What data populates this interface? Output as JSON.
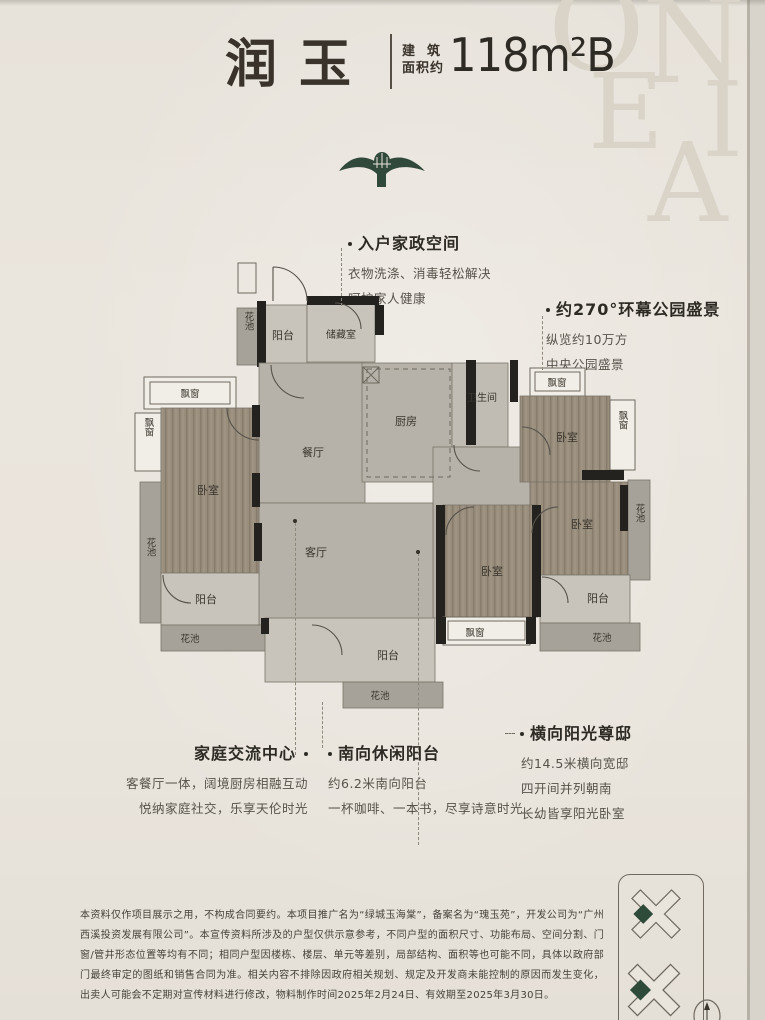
{
  "header": {
    "title": "润玉",
    "area_label_line1": "建筑",
    "area_label_line2": "面积约",
    "area_value": "118m²B"
  },
  "watermark": {
    "letters": [
      "O",
      "N",
      "E",
      "I",
      "A"
    ]
  },
  "annotations": {
    "entry": {
      "title": "入户家政空间",
      "lines": [
        "衣物洗涤、消毒轻松解决",
        "呵护家人健康"
      ]
    },
    "park": {
      "title": "约270°环幕公园盛景",
      "lines": [
        "纵览约10万方",
        "中央公园盛景"
      ]
    },
    "family": {
      "title": "家庭交流中心",
      "lines": [
        "客餐厅一体，阔境厨房相融互动",
        "悦纳家庭社交，乐享天伦时光"
      ]
    },
    "south_balcony": {
      "title": "南向休闲阳台",
      "lines": [
        "约6.2米南向阳台",
        "一杯咖啡、一本书，尽享诗意时光"
      ]
    },
    "sunshine": {
      "title": "横向阳光尊邸",
      "lines": [
        "约14.5米横向宽邸",
        "四开间并列朝南",
        "长幼皆享阳光卧室"
      ]
    }
  },
  "floor_plan": {
    "rooms": [
      {
        "id": "flower-top",
        "label": "花池"
      },
      {
        "id": "entry-balcony",
        "label": "阳台"
      },
      {
        "id": "storage",
        "label": "储藏室"
      },
      {
        "id": "bay-top-left",
        "label": "飘窗"
      },
      {
        "id": "bay-left",
        "label": "飘窗"
      },
      {
        "id": "bedroom-left",
        "label": "卧室"
      },
      {
        "id": "dining",
        "label": "餐厅"
      },
      {
        "id": "kitchen",
        "label": "厨房"
      },
      {
        "id": "bathroom",
        "label": "卫生间"
      },
      {
        "id": "bay-top-right",
        "label": "飘窗"
      },
      {
        "id": "bedroom-top-right",
        "label": "卧室"
      },
      {
        "id": "bay-right",
        "label": "飘窗"
      },
      {
        "id": "living",
        "label": "客厅"
      },
      {
        "id": "bedroom-right",
        "label": "卧室"
      },
      {
        "id": "flower-left",
        "label": "花池"
      },
      {
        "id": "balcony-left",
        "label": "阳台"
      },
      {
        "id": "flower-bottom-left",
        "label": "花池"
      },
      {
        "id": "bedroom-bottom",
        "label": "卧室"
      },
      {
        "id": "flower-right",
        "label": "花池"
      },
      {
        "id": "balcony-right",
        "label": "阳台"
      },
      {
        "id": "bay-bottom",
        "label": "飘窗"
      },
      {
        "id": "flower-bottom-right",
        "label": "花池"
      },
      {
        "id": "balcony-south",
        "label": "阳台"
      },
      {
        "id": "flower-bottom-center",
        "label": "花池"
      }
    ]
  },
  "disclaimer": "本资料仅作项目展示之用，不构成合同要约。本项目推广名为“绿城玉海棠”，备案名为“瑰玉苑”，开发公司为“广州西溪投资发展有限公司”。本宣传资料所涉及的户型仅供示意参考，不同户型的面积尺寸、功能布局、空间分割、门窗/管井形态位置等均有不同；相同户型因楼栋、楼层、单元等差别，局部结构、面积等也可能不同，具体以政府部门最终审定的图纸和销售合同为准。相关内容不排除因政府相关规划、规定及开发商未能控制的原因而发生变化，出卖人可能会不定期对宣传材料进行修改，物料制作时间2025年2月24日、有效期至2025年3月30日。",
  "colors": {
    "brand_green": "#30493a",
    "paper": "#e9e4dc",
    "wall": "#23221e",
    "bedroom_wood": "#998d7c"
  }
}
